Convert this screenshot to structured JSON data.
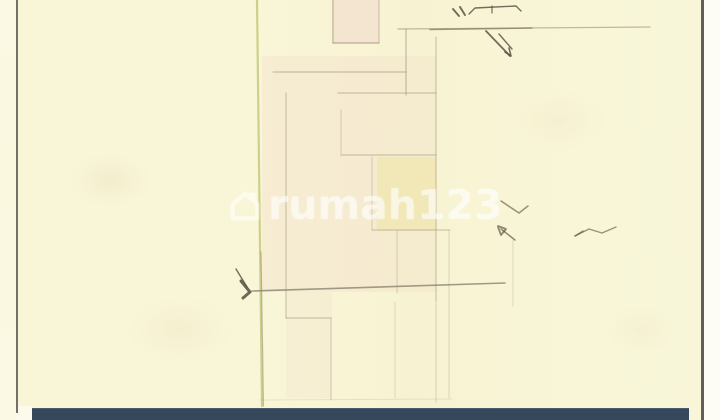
{
  "scene": {
    "type": "scanned hand-drawn floor plan sketch",
    "watermark": {
      "label": "rumah123",
      "icon": "house-icon"
    },
    "colors": {
      "paper": "#f9f6d8",
      "paper_light": "#fbf9e4",
      "boundary": "#c6ca7c",
      "pencil": "#a89d86",
      "pencil_dark": "#8a8471",
      "ink": "#55503f",
      "edge": "#505048",
      "bar": "#36495c",
      "bar_top": "#4c5c6d",
      "margin_white": "#fdfdf6",
      "watermark_white": "rgba(255,255,255,0.52)"
    },
    "sketch": {
      "tints": [
        {
          "x": 334,
          "y": 0,
          "w": 45,
          "h": 43,
          "c": "#efd5cb",
          "o": 0.5
        },
        {
          "x": 262,
          "y": 56,
          "w": 174,
          "h": 236,
          "c": "#f3dac9",
          "o": 0.33
        },
        {
          "x": 286,
          "y": 292,
          "w": 46,
          "h": 106,
          "c": "#f3dac9",
          "o": 0.22
        },
        {
          "x": 377,
          "y": 157,
          "w": 59,
          "h": 74,
          "c": "#eee29a",
          "o": 0.45
        }
      ],
      "lines": [
        {
          "x1": 257,
          "y1": 0,
          "x2": 262,
          "y2": 406,
          "w": 2.2,
          "o": 0.85,
          "c": "#c6ca7c"
        },
        {
          "x1": 261,
          "y1": 252,
          "x2": 263.5,
          "y2": 406,
          "w": 1.2,
          "o": 0.5,
          "c": "#8b8674"
        },
        {
          "x1": 333,
          "y1": 0,
          "x2": 333,
          "y2": 43,
          "w": 1.2,
          "o": 0.8
        },
        {
          "x1": 379,
          "y1": 0,
          "x2": 379,
          "y2": 43,
          "w": 1.1,
          "o": 0.55
        },
        {
          "x1": 333,
          "y1": 43,
          "x2": 379,
          "y2": 43,
          "w": 1.2,
          "o": 0.8
        },
        {
          "x1": 398,
          "y1": 29,
          "x2": 650,
          "y2": 27,
          "w": 1.3,
          "o": 0.7
        },
        {
          "x1": 430,
          "y1": 29.5,
          "x2": 532,
          "y2": 28,
          "w": 1.5,
          "o": 0.8,
          "c": "#8d8268"
        },
        {
          "x1": 406,
          "y1": 29,
          "x2": 406,
          "y2": 95,
          "w": 1.2,
          "o": 0.65
        },
        {
          "x1": 436,
          "y1": 37,
          "x2": 436,
          "y2": 300,
          "w": 1.2,
          "o": 0.55
        },
        {
          "x1": 436,
          "y1": 300,
          "x2": 436,
          "y2": 402,
          "w": 1.1,
          "o": 0.35
        },
        {
          "x1": 273,
          "y1": 72,
          "x2": 406,
          "y2": 72,
          "w": 1.2,
          "o": 0.6
        },
        {
          "x1": 338,
          "y1": 93,
          "x2": 436,
          "y2": 93,
          "w": 1.2,
          "o": 0.55
        },
        {
          "x1": 286,
          "y1": 93,
          "x2": 286,
          "y2": 318,
          "w": 1.2,
          "o": 0.55
        },
        {
          "x1": 286,
          "y1": 318,
          "x2": 331,
          "y2": 318,
          "w": 1.2,
          "o": 0.55
        },
        {
          "x1": 331,
          "y1": 318,
          "x2": 331,
          "y2": 400,
          "w": 1.1,
          "o": 0.45
        },
        {
          "x1": 341,
          "y1": 110,
          "x2": 341,
          "y2": 156,
          "w": 1.1,
          "o": 0.4
        },
        {
          "x1": 342,
          "y1": 155,
          "x2": 436,
          "y2": 155,
          "w": 1.2,
          "o": 0.55
        },
        {
          "x1": 372,
          "y1": 157,
          "x2": 372,
          "y2": 230,
          "w": 1.1,
          "o": 0.38
        },
        {
          "x1": 372,
          "y1": 230,
          "x2": 450,
          "y2": 230,
          "w": 1.2,
          "o": 0.5
        },
        {
          "x1": 397,
          "y1": 231,
          "x2": 397,
          "y2": 293,
          "w": 1.1,
          "o": 0.4
        },
        {
          "x1": 449,
          "y1": 231,
          "x2": 449,
          "y2": 398,
          "w": 1.1,
          "o": 0.33
        },
        {
          "x1": 252,
          "y1": 291,
          "x2": 505,
          "y2": 283,
          "w": 1.6,
          "o": 0.8,
          "c": "#8a8471"
        },
        {
          "x1": 513,
          "y1": 240,
          "x2": 513,
          "y2": 306,
          "w": 1.1,
          "o": 0.3
        },
        {
          "x1": 395,
          "y1": 302,
          "x2": 395,
          "y2": 398,
          "w": 1.1,
          "o": 0.28
        },
        {
          "x1": 260,
          "y1": 400,
          "x2": 452,
          "y2": 399,
          "w": 1,
          "o": 0.22
        }
      ],
      "strokes": [
        {
          "pts": "453,9 459,16",
          "w": 2
        },
        {
          "pts": "460,7 465,15",
          "w": 2
        },
        {
          "pts": "469,14 475,8 516,6 521,11",
          "w": 1.4
        },
        {
          "pts": "492,6 492,13",
          "w": 1.2
        },
        {
          "pts": "486,31 510,56",
          "w": 1.8
        },
        {
          "pts": "499,34 512,49",
          "w": 1.4
        },
        {
          "pts": "505,52 511,56 509,48",
          "w": 1.6
        },
        {
          "pts": "501,201 519,213 528,206",
          "w": 1.5,
          "o": 0.6
        },
        {
          "pts": "515,240 501,229",
          "w": 1.5,
          "o": 0.65
        },
        {
          "pts": "498,226 506,229 501,235 498,227",
          "w": 1.8,
          "o": 0.65
        },
        {
          "pts": "616,227 602,233 589,229 575,236",
          "w": 1.4,
          "o": 0.6
        },
        {
          "pts": "575,236 583,231",
          "w": 1.4,
          "o": 0.6
        },
        {
          "pts": "236,269 247,287",
          "w": 1.5,
          "o": 0.8
        },
        {
          "pts": "241,281 250,292 243,298",
          "w": 3,
          "o": 0.85
        }
      ]
    }
  }
}
